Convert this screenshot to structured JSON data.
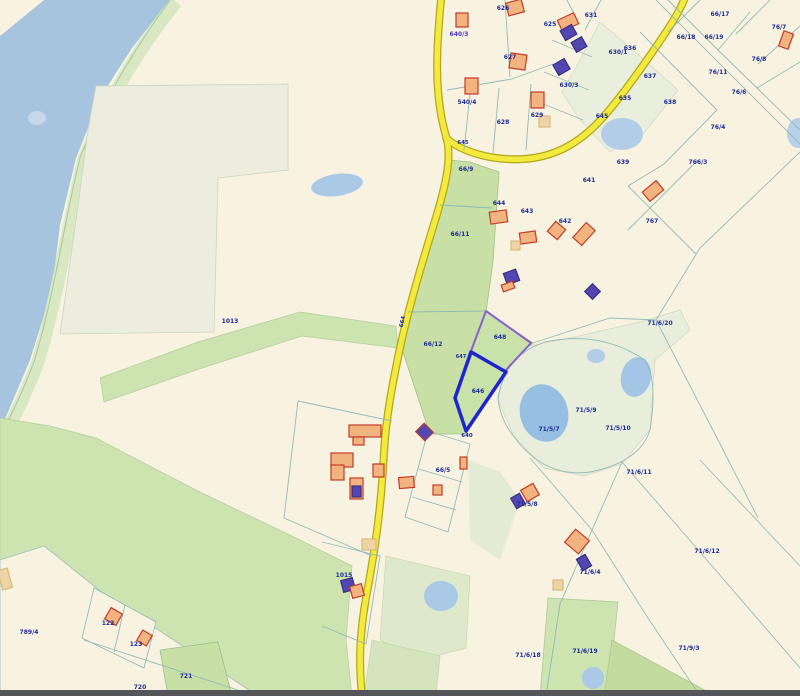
{
  "map": {
    "colors": {
      "background": "#f8f2e1",
      "lake": "#a7c4df",
      "shore_strip": "#d8e8c2",
      "shore_line": "#a9c79c",
      "green_parcel": "#c8e0a6",
      "green_band": "#cde3b0",
      "pale_field": "#ededdf",
      "pale_pond_area": "#e8eedb",
      "pond": "#9bc0e4",
      "road_fill": "#f3ea3e",
      "road_casing": "#b3a71c",
      "boundary_line": "#8cb8b4",
      "label_text": "#1d2d96",
      "address_text": "#4537b4",
      "highlight_selected": "#1d25cf",
      "highlight_adjacent": "#8a62cc",
      "building_orange_fill": "#f2b47e",
      "building_orange_stroke": "#c23b2b",
      "building_purple_fill": "#5247b2",
      "building_tan_fill": "#eed3a4",
      "bottom_bar": "#55565a"
    },
    "highlight": {
      "selected_parcel": "646",
      "adjacent_parcel": "648",
      "parcels": [
        {
          "name": "648",
          "pts": "486,311 531,343 505,371 471,351",
          "stroke": "#8a62cc",
          "sw": 2,
          "fill": "#c9e2a9"
        },
        {
          "name": "646",
          "pts": "471,352 506,372 466,431 455,398",
          "stroke": "#1d25cf",
          "sw": 3.5,
          "fill": "#c9e2a9"
        }
      ]
    },
    "areas": [
      {
        "shape": "path",
        "d": "M44,0 L170,0 L132,48 L100,98 L76,158 L60,225 L52,290 L30,360 L8,412 L0,430 L0,36 Z",
        "fill": "#a7c4df",
        "name": "lake"
      },
      {
        "shape": "polygon",
        "pts": "0,0 44,0 0,36",
        "fill": "#f8f2e1",
        "name": "shore-wedge"
      },
      {
        "shape": "path",
        "d": "M176,2 C142,44 108,98 84,160 C68,224 60,288 38,362 C22,404 10,424 4,438",
        "fill": "none",
        "stroke": "#d8e8c2",
        "sw": 13,
        "name": "shore-strip"
      },
      {
        "shape": "path",
        "d": "M170,0 C138,44 104,98 80,158 C64,222 56,288 34,362 C18,404 6,424 0,436",
        "fill": "none",
        "stroke": "#a9c79c",
        "sw": 1,
        "name": "shoreline"
      },
      {
        "shape": "polygon",
        "pts": "96,86 288,84 288,170 218,178 214,332 60,334 78,206 88,130",
        "fill": "#ededdf",
        "stroke": "#ccd4c2",
        "sw": 0.8,
        "name": "pale-field"
      },
      {
        "shape": "polygon",
        "pts": "100,378 198,342 300,312 396,326 398,348 302,336 202,368 104,402",
        "fill": "#cde3b0",
        "stroke": "#b4cf9a",
        "sw": 0.7,
        "name": "green-band"
      },
      {
        "shape": "polygon",
        "pts": "449,160 470,162 499,172 493,262 486,312 533,343 506,372 466,434 430,434 403,352 410,310 424,266 436,228 443,194",
        "fill": "#c8e0a6",
        "stroke": "#9ec08a",
        "sw": 0.8,
        "name": "green-roadside-parcels"
      },
      {
        "shape": "polygon",
        "pts": "498,400 506,370 520,348 570,338 640,322 680,310 690,330 655,360 650,430 622,464 584,476 544,468 514,436",
        "fill": "#e8eedb",
        "stroke": "#cdd8c0",
        "sw": 0.7,
        "name": "pond-parcel-area"
      },
      {
        "shape": "polygon",
        "pts": "600,22 640,56 678,90 645,132 610,152 580,120 562,92 580,60",
        "fill": "#eaeedc",
        "stroke": "#ccd6bd",
        "sw": 0.6,
        "name": "ne-pale-parcels"
      },
      {
        "shape": "polygon",
        "pts": "0,418 50,426 96,438 200,492 300,540 352,566 346,640 352,696 0,696",
        "fill": "#cde3b0",
        "stroke": "#b4cf9a",
        "sw": 0.7,
        "name": "sw-green-field"
      },
      {
        "shape": "polygon",
        "pts": "0,560 44,546 104,594 258,696 0,696",
        "fill": "#f8f2e1",
        "stroke": "#9fc0ba",
        "sw": 0.8,
        "name": "parcel-789-4"
      },
      {
        "shape": "polygon",
        "pts": "94,588 156,622 144,668 82,638",
        "fill": "#f8f2e1",
        "stroke": "#8cb8b4",
        "sw": 0.8,
        "name": "parcels-122-123"
      },
      {
        "shape": "polygon",
        "pts": "160,650 218,642 232,696 168,696",
        "fill": "#c8e0a6",
        "stroke": "#9ec08a",
        "sw": 0.8,
        "name": "parcel-721"
      },
      {
        "shape": "polygon",
        "pts": "548,598 618,602 608,696 540,696",
        "fill": "#cde3b0",
        "stroke": "#aac794",
        "sw": 0.7,
        "name": "parcel-71-6-19"
      },
      {
        "shape": "polygon",
        "pts": "612,640 716,696 604,696",
        "fill": "#c4db9e",
        "stroke": "#a8c488",
        "sw": 0.7,
        "name": "se-green-wedge"
      },
      {
        "shape": "polygon",
        "pts": "386,556 470,576 466,648 420,660 380,640",
        "fill": "#dde9ca",
        "stroke": "#c2d4ac",
        "sw": 0.6,
        "name": "pond-field-east-of-road"
      },
      {
        "shape": "polygon",
        "pts": "372,640 440,656 436,696 364,696",
        "fill": "#d4e4bc",
        "stroke": "#bed4a2",
        "sw": 0.6,
        "name": "green-strip-bottom"
      },
      {
        "shape": "polygon",
        "pts": "468,460 500,472 520,500 500,560 470,540",
        "fill": "#e3ebd3",
        "stroke": "none",
        "sw": 0,
        "name": "pale-strip-mid"
      }
    ],
    "ponds": [
      {
        "cx": 337,
        "cy": 185,
        "rx": 26,
        "ry": 11,
        "rot": -8,
        "fill": "#aac9e6",
        "name": "pond-field-west"
      },
      {
        "cx": 544,
        "cy": 413,
        "rx": 24,
        "ry": 29,
        "rot": -15,
        "fill": "#97bfe2",
        "name": "pond-main"
      },
      {
        "cx": 636,
        "cy": 377,
        "rx": 15,
        "ry": 20,
        "rot": 12,
        "fill": "#a3c6e6",
        "name": "pond-east"
      },
      {
        "cx": 596,
        "cy": 356,
        "rx": 9,
        "ry": 7,
        "rot": 0,
        "fill": "#b3cde8",
        "name": "pond-small-mid"
      },
      {
        "cx": 622,
        "cy": 134,
        "rx": 21,
        "ry": 16,
        "rot": 0,
        "fill": "#b3cde8",
        "name": "pond-north"
      },
      {
        "cx": 441,
        "cy": 596,
        "rx": 17,
        "ry": 15,
        "rot": 0,
        "fill": "#a9c9e6",
        "name": "pond-south-road"
      },
      {
        "cx": 593,
        "cy": 678,
        "rx": 11,
        "ry": 11,
        "rot": 0,
        "fill": "#a9c9e6",
        "name": "pond-south"
      },
      {
        "cx": 798,
        "cy": 133,
        "rx": 11,
        "ry": 15,
        "rot": 0,
        "fill": "#b9d1e8",
        "name": "pond-ne-corner"
      },
      {
        "cx": 37,
        "cy": 118,
        "rx": 9,
        "ry": 7,
        "rot": 0,
        "fill": "#c6d7ea",
        "name": "lake-shallow-mark"
      }
    ],
    "roads": [
      {
        "name": "main-road",
        "d": "M441,0 C437,42 433,92 446,136 C452,156 447,182 434,224 C421,266 408,310 400,348 C392,386 386,418 384,452 C381,510 375,550 366,598 C359,638 359,666 362,696"
      },
      {
        "name": "branch-road",
        "d": "M446,138 C462,152 492,161 524,159 C556,157 582,142 606,114 C628,88 650,56 666,32 C674,20 680,10 684,0"
      }
    ],
    "boundary_lines": [
      "M505,0 L510,77",
      "M447,90 L512,79 L553,64",
      "M470,94 L464,150",
      "M499,88 L493,153",
      "M531,84 L526,150",
      "M567,0 L578,22",
      "M601,0 L585,30",
      "M552,40 L592,57",
      "M544,72 L589,90",
      "M536,101 L583,120",
      "M668,0 L718,50 L750,12",
      "M718,50 L757,88 L800,62",
      "M640,32 L717,110",
      "M700,0 L668,32",
      "M770,0 L736,34",
      "M800,26 L758,64",
      "M757,88 L800,130",
      "M656,0 L800,144",
      "M717,110 L664,164 L628,186",
      "M698,160 L628,230",
      "M628,186 L696,254",
      "M800,152 L700,248 L656,320",
      "M533,343 L610,318 L656,320",
      "M656,320 L718,440 L758,518",
      "M440,205 L492,208",
      "M408,312 L487,311",
      "M530,458 L592,530 L648,618 L700,696",
      "M622,462 L592,530",
      "M592,530 L560,604 L546,696",
      "M622,462 L700,552 L800,668",
      "M700,460 L800,566",
      "M428,431 L470,444 L448,532 L405,517 L428,431",
      "M419,469 L462,482",
      "M412,497 L456,510",
      "M298,401 L392,421",
      "M298,401 L284,518",
      "M284,518 L372,556",
      "M322,542 L380,556 L366,644 L322,626",
      "M125,605 L114,652",
      "M84,640 L250,694",
      "M498,398 Q505,355 545,342 Q600,330 645,360 Q658,380 650,430 Q640,462 590,472 Q545,478 515,438 Q500,420 498,398"
    ],
    "buildings": [
      {
        "k": "o",
        "x": 507,
        "y": 1,
        "w": 16,
        "h": 13,
        "r": -15
      },
      {
        "k": "o",
        "x": 456,
        "y": 13,
        "w": 12,
        "h": 14,
        "r": 0
      },
      {
        "k": "o",
        "x": 559,
        "y": 16,
        "w": 18,
        "h": 12,
        "r": -25
      },
      {
        "k": "p",
        "x": 562,
        "y": 27,
        "w": 13,
        "h": 11,
        "r": -30
      },
      {
        "k": "p",
        "x": 573,
        "y": 39,
        "w": 12,
        "h": 11,
        "r": -30
      },
      {
        "k": "p",
        "x": 555,
        "y": 61,
        "w": 13,
        "h": 12,
        "r": -30
      },
      {
        "k": "o",
        "x": 510,
        "y": 54,
        "w": 16,
        "h": 15,
        "r": 8
      },
      {
        "k": "o",
        "x": 465,
        "y": 78,
        "w": 13,
        "h": 16,
        "r": 0
      },
      {
        "k": "o",
        "x": 531,
        "y": 92,
        "w": 13,
        "h": 16,
        "r": 0
      },
      {
        "k": "t",
        "x": 539,
        "y": 116,
        "w": 11,
        "h": 11,
        "r": 0
      },
      {
        "k": "o",
        "x": 781,
        "y": 32,
        "w": 10,
        "h": 16,
        "r": 20
      },
      {
        "k": "o",
        "x": 644,
        "y": 185,
        "w": 18,
        "h": 12,
        "r": -40
      },
      {
        "k": "o",
        "x": 490,
        "y": 211,
        "w": 17,
        "h": 12,
        "r": -8
      },
      {
        "k": "o",
        "x": 520,
        "y": 232,
        "w": 16,
        "h": 11,
        "r": -8
      },
      {
        "k": "t",
        "x": 511,
        "y": 241,
        "w": 9,
        "h": 9,
        "r": 0
      },
      {
        "k": "o",
        "x": 550,
        "y": 224,
        "w": 13,
        "h": 13,
        "r": 40
      },
      {
        "k": "o",
        "x": 574,
        "y": 228,
        "w": 20,
        "h": 12,
        "r": -48
      },
      {
        "k": "p",
        "x": 505,
        "y": 271,
        "w": 13,
        "h": 12,
        "r": -20
      },
      {
        "k": "o",
        "x": 502,
        "y": 283,
        "w": 12,
        "h": 7,
        "r": -20
      },
      {
        "k": "p",
        "x": 587,
        "y": 286,
        "w": 11,
        "h": 11,
        "r": 45
      },
      {
        "k": "o",
        "x": 349,
        "y": 425,
        "w": 32,
        "h": 12,
        "r": 0
      },
      {
        "k": "o",
        "x": 353,
        "y": 437,
        "w": 11,
        "h": 8,
        "r": 0
      },
      {
        "k": "pr",
        "x": 418,
        "y": 426,
        "w": 13,
        "h": 12,
        "r": 45
      },
      {
        "k": "o",
        "x": 331,
        "y": 453,
        "w": 22,
        "h": 14,
        "r": 0
      },
      {
        "k": "o",
        "x": 331,
        "y": 465,
        "w": 13,
        "h": 15,
        "r": 0
      },
      {
        "k": "o",
        "x": 373,
        "y": 464,
        "w": 11,
        "h": 13,
        "r": 0
      },
      {
        "k": "o",
        "x": 350,
        "y": 478,
        "w": 13,
        "h": 21,
        "r": 0
      },
      {
        "k": "p",
        "x": 352,
        "y": 486,
        "w": 9,
        "h": 11,
        "r": 0
      },
      {
        "k": "o",
        "x": 399,
        "y": 477,
        "w": 15,
        "h": 11,
        "r": -5
      },
      {
        "k": "o",
        "x": 433,
        "y": 485,
        "w": 9,
        "h": 10,
        "r": 0
      },
      {
        "k": "o",
        "x": 460,
        "y": 457,
        "w": 7,
        "h": 12,
        "r": 0
      },
      {
        "k": "t",
        "x": 362,
        "y": 539,
        "w": 14,
        "h": 11,
        "r": 0
      },
      {
        "k": "p",
        "x": 342,
        "y": 579,
        "w": 12,
        "h": 12,
        "r": -15
      },
      {
        "k": "o",
        "x": 351,
        "y": 585,
        "w": 12,
        "h": 12,
        "r": -15
      },
      {
        "k": "o",
        "x": 523,
        "y": 486,
        "w": 14,
        "h": 13,
        "r": -30
      },
      {
        "k": "p",
        "x": 513,
        "y": 495,
        "w": 10,
        "h": 12,
        "r": -30
      },
      {
        "k": "o",
        "x": 568,
        "y": 533,
        "w": 18,
        "h": 17,
        "r": 40
      },
      {
        "k": "p",
        "x": 579,
        "y": 556,
        "w": 10,
        "h": 13,
        "r": -30
      },
      {
        "k": "t",
        "x": 553,
        "y": 580,
        "w": 10,
        "h": 10,
        "r": 0
      },
      {
        "k": "o",
        "x": 107,
        "y": 610,
        "w": 13,
        "h": 13,
        "r": 30
      },
      {
        "k": "o",
        "x": 139,
        "y": 632,
        "w": 11,
        "h": 12,
        "r": 30
      },
      {
        "k": "t",
        "x": 0,
        "y": 569,
        "w": 10,
        "h": 20,
        "r": -15
      }
    ],
    "labels": [
      {
        "t": "626",
        "x": 503,
        "y": 10
      },
      {
        "t": "640/3",
        "x": 459,
        "y": 36,
        "c": "#4537b4",
        "b": true
      },
      {
        "t": "625",
        "x": 550,
        "y": 26
      },
      {
        "t": "631",
        "x": 591,
        "y": 17
      },
      {
        "t": "630/1",
        "x": 618,
        "y": 54
      },
      {
        "t": "630/3",
        "x": 569,
        "y": 87
      },
      {
        "t": "636",
        "x": 630,
        "y": 50
      },
      {
        "t": "637",
        "x": 650,
        "y": 78
      },
      {
        "t": "635",
        "x": 625,
        "y": 100
      },
      {
        "t": "645",
        "x": 602,
        "y": 118
      },
      {
        "t": "627",
        "x": 510,
        "y": 59
      },
      {
        "t": "540/4",
        "x": 467,
        "y": 104
      },
      {
        "t": "628",
        "x": 503,
        "y": 124
      },
      {
        "t": "629",
        "x": 537,
        "y": 117
      },
      {
        "t": "66/17",
        "x": 720,
        "y": 16
      },
      {
        "t": "76/7",
        "x": 779,
        "y": 29
      },
      {
        "t": "66/18",
        "x": 686,
        "y": 39
      },
      {
        "t": "66/19",
        "x": 714,
        "y": 39
      },
      {
        "t": "76/8",
        "x": 759,
        "y": 61
      },
      {
        "t": "76/11",
        "x": 718,
        "y": 74
      },
      {
        "t": "76/6",
        "x": 739,
        "y": 94
      },
      {
        "t": "638",
        "x": 670,
        "y": 104
      },
      {
        "t": "76/4",
        "x": 718,
        "y": 129
      },
      {
        "t": "639",
        "x": 623,
        "y": 164
      },
      {
        "t": "766/3",
        "x": 698,
        "y": 164
      },
      {
        "t": "767",
        "x": 652,
        "y": 223
      },
      {
        "t": "645",
        "x": 463,
        "y": 144,
        "fs": 5.5
      },
      {
        "t": "66/9",
        "x": 466,
        "y": 171
      },
      {
        "t": "641",
        "x": 589,
        "y": 182
      },
      {
        "t": "644",
        "x": 499,
        "y": 205
      },
      {
        "t": "643",
        "x": 527,
        "y": 213
      },
      {
        "t": "642",
        "x": 565,
        "y": 223
      },
      {
        "t": "66/11",
        "x": 460,
        "y": 236
      },
      {
        "t": "1013",
        "x": 230,
        "y": 323
      },
      {
        "t": "664",
        "x": 404,
        "y": 322,
        "rot": -78,
        "fs": 5.5
      },
      {
        "t": "66/12",
        "x": 433,
        "y": 346
      },
      {
        "t": "648",
        "x": 500,
        "y": 339
      },
      {
        "t": "647",
        "x": 461,
        "y": 358,
        "fs": 5
      },
      {
        "t": "646",
        "x": 478,
        "y": 393
      },
      {
        "t": "640",
        "x": 467,
        "y": 437,
        "fs": 5.5
      },
      {
        "t": "71/6/20",
        "x": 660,
        "y": 325
      },
      {
        "t": "71/5/9",
        "x": 586,
        "y": 412
      },
      {
        "t": "71/5/10",
        "x": 618,
        "y": 430
      },
      {
        "t": "71/5/7",
        "x": 549,
        "y": 431
      },
      {
        "t": "66/5",
        "x": 443,
        "y": 472
      },
      {
        "t": "71/6/11",
        "x": 639,
        "y": 474
      },
      {
        "t": "71/5/8",
        "x": 527,
        "y": 506
      },
      {
        "t": "71/6/12",
        "x": 707,
        "y": 553
      },
      {
        "t": "71/6/4",
        "x": 590,
        "y": 574
      },
      {
        "t": "1015",
        "x": 344,
        "y": 577
      },
      {
        "t": "789/4",
        "x": 29,
        "y": 634
      },
      {
        "t": "122",
        "x": 108,
        "y": 625
      },
      {
        "t": "123",
        "x": 136,
        "y": 646
      },
      {
        "t": "71/6/18",
        "x": 528,
        "y": 657
      },
      {
        "t": "71/6/19",
        "x": 585,
        "y": 653
      },
      {
        "t": "71/9/3",
        "x": 689,
        "y": 650
      },
      {
        "t": "721",
        "x": 186,
        "y": 678
      },
      {
        "t": "720",
        "x": 140,
        "y": 689
      }
    ],
    "frame": {
      "bottom_bar": {
        "x": 0,
        "y": 690,
        "w": 800,
        "h": 6,
        "fill": "#55565a"
      }
    }
  }
}
